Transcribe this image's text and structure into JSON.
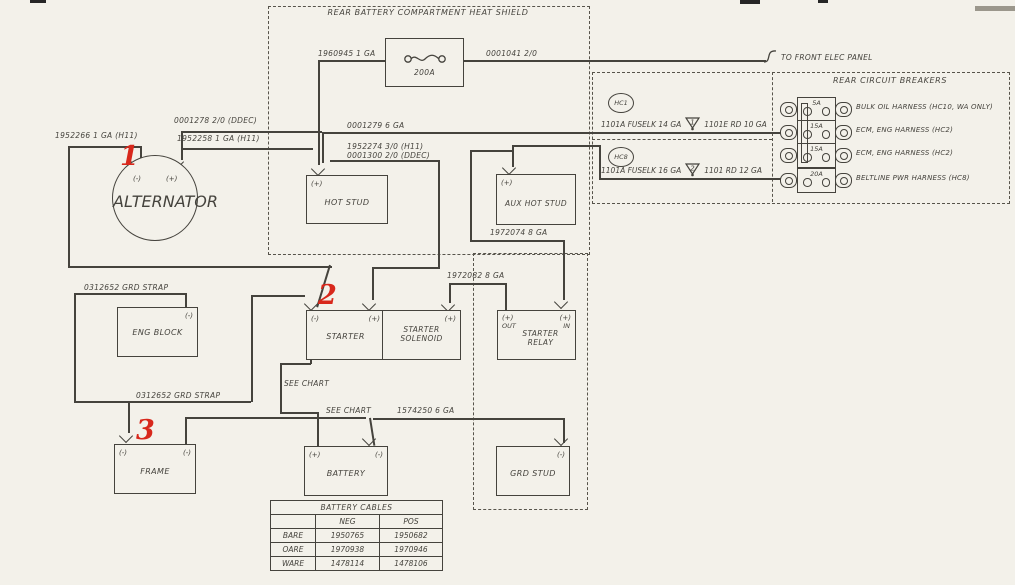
{
  "titles": {
    "heat_shield": "REAR BATTERY COMPARTMENT HEAT SHIELD",
    "circuit_breakers": "REAR CIRCUIT BREAKERS",
    "to_front_panel": "TO FRONT ELEC PANEL"
  },
  "components": {
    "alternator": "ALTERNATOR",
    "hot_stud": "HOT STUD",
    "aux_hot_stud": "AUX HOT STUD",
    "eng_block": "ENG BLOCK",
    "starter": "STARTER",
    "starter_solenoid": "STARTER SOLENOID",
    "starter_relay": "STARTER RELAY",
    "frame": "FRAME",
    "battery": "BATTERY",
    "grd_stud": "GRD STUD",
    "fuse_rating": "200A"
  },
  "terminals": {
    "neg": "(-)",
    "pos": "(+)",
    "out": "OUT",
    "in": "IN"
  },
  "hc": {
    "hc1": "HC1",
    "hc8": "HC8"
  },
  "wire_labels": {
    "w1952266": "1952266  1 GA (H11)",
    "w0001278": "0001278  2/0 (DDEC)",
    "w1952258": "1952258  1 GA (H11)",
    "w1960945": "1960945  1 GA",
    "w0001041": "0001041  2/0",
    "w0001279": "0001279  6 GA",
    "w1952274": "1952274  3/0 (H11)",
    "w0001300": "0001300  2/0 (DDEC)",
    "w1972074": "1972074  8 GA",
    "w1972082": "1972082  8 GA",
    "w1574250": "1574250  6 GA",
    "grd_strap": "0312652  GRD STRAP",
    "see_chart": "SEE CHART",
    "fuselink14": "1101A FUSELK 14 GA",
    "rd10": "1101E RD 10 GA",
    "fuselink16": "1101A FUSELK 16 GA",
    "rd12": "1101 RD 12 GA"
  },
  "fuse_links": {
    "t1": "1",
    "t2": "2"
  },
  "breakers": [
    {
      "amps": "5A",
      "harness": "BULK OIL HARNESS (HC10, WA ONLY)"
    },
    {
      "amps": "15A",
      "harness": "ECM, ENG HARNESS (HC2)"
    },
    {
      "amps": "15A",
      "harness": "ECM, ENG HARNESS (HC2)"
    },
    {
      "amps": "20A",
      "harness": "BELTLINE PWR HARNESS (HC8)"
    }
  ],
  "callouts": [
    "1",
    "2",
    "3"
  ],
  "battery_cables": {
    "title": "BATTERY CABLES",
    "columns": [
      "NEG",
      "POS"
    ],
    "rows": [
      {
        "model": "BARE",
        "neg": "1950765",
        "pos": "1950682"
      },
      {
        "model": "OARE",
        "neg": "1970938",
        "pos": "1970946"
      },
      {
        "model": "WARE",
        "neg": "1478114",
        "pos": "1478106"
      }
    ]
  }
}
